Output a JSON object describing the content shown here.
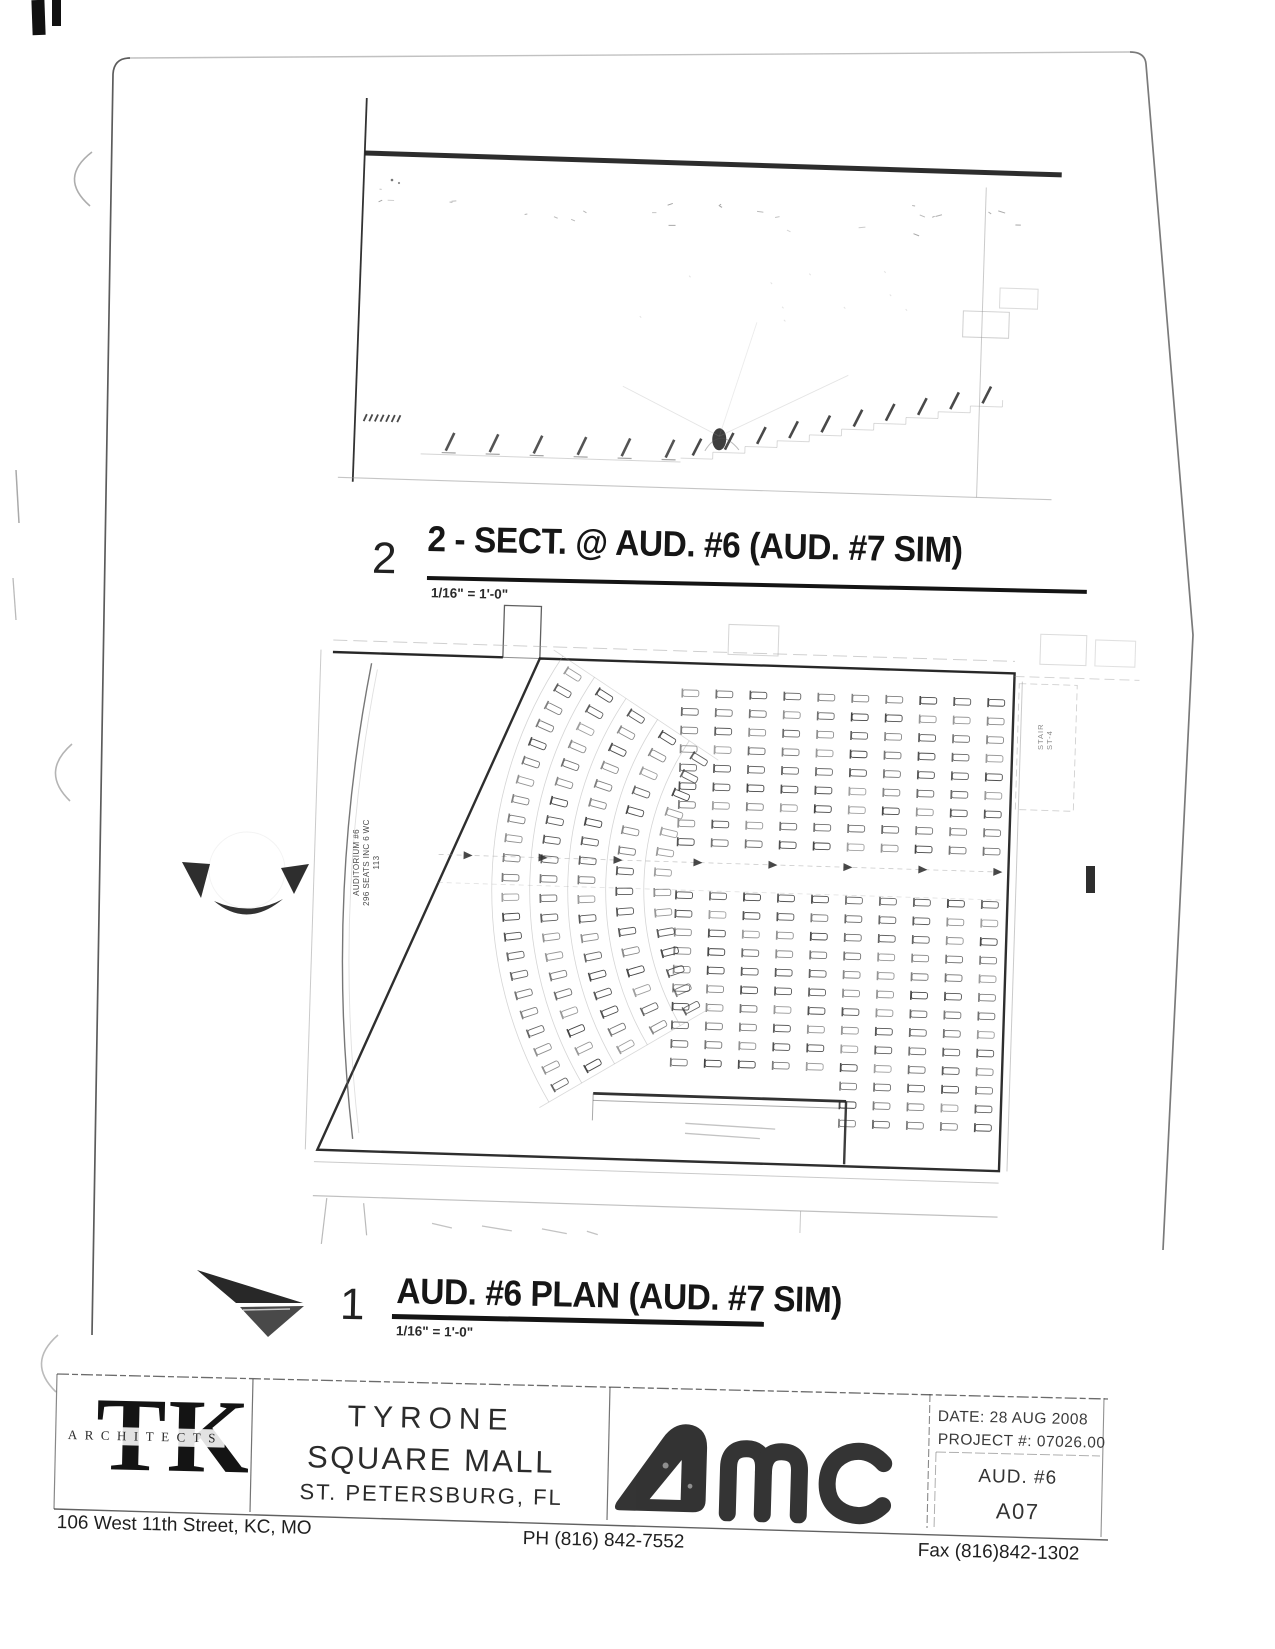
{
  "sheet": {
    "section_view": {
      "number": "2",
      "title": "2 - SECT. @ AUD. #6 (AUD. #7 SIM)",
      "scale": "1/16\" = 1'-0\""
    },
    "plan_view": {
      "number": "1",
      "title": "AUD. #6 PLAN (AUD. #7 SIM)",
      "scale": "1/16\" = 1'-0\""
    },
    "plan_annotations": {
      "auditorium": "AUDITORIUM #6",
      "seats": "296 SEATS INC 6 WC",
      "room_number": "113",
      "stair": "STAIR",
      "stair_id": "ST-4"
    },
    "title_block": {
      "architect": {
        "initials": "TK",
        "name": "ARCHITECTS",
        "address": "106 West 11th Street,  KC, MO",
        "phone": "PH (816) 842-7552",
        "fax": "Fax (816)842-1302"
      },
      "project": {
        "line1": "TYRONE",
        "line2": "SQUARE MALL",
        "line3": "ST. PETERSBURG, FL"
      },
      "client": "AMC",
      "info": {
        "date": "DATE: 28 AUG 2008",
        "project_no": "PROJECT #: 07026.00",
        "sheet_title": "AUD. #6",
        "sheet_no": "A07"
      }
    }
  },
  "drawing": {
    "ink": "#1c1c1c",
    "mid": "#555555",
    "faint": "#979797",
    "plan": {
      "rot": 1.8,
      "pivot": [
        333,
        650
      ],
      "room": {
        "x": 333,
        "y": 650,
        "w": 682,
        "h": 500
      },
      "grid": {
        "col_start": 692,
        "col_step": 34,
        "cols": 10,
        "row_start": 682,
        "row_step": 18.6,
        "rows_upper": 9,
        "lower_start": 884,
        "rows_lower_left": 10,
        "rows_lower_right": 13,
        "split_x": 860
      },
      "fan": {
        "center": [
          920,
          872
        ],
        "radii": [
          250,
          288,
          326,
          364,
          402
        ],
        "spacing": 19,
        "a0": 148,
        "a1": 212
      },
      "aisle_y": 851
    },
    "section": {
      "rot": 1.8,
      "pivot": [
        365,
        155
      ]
    }
  }
}
